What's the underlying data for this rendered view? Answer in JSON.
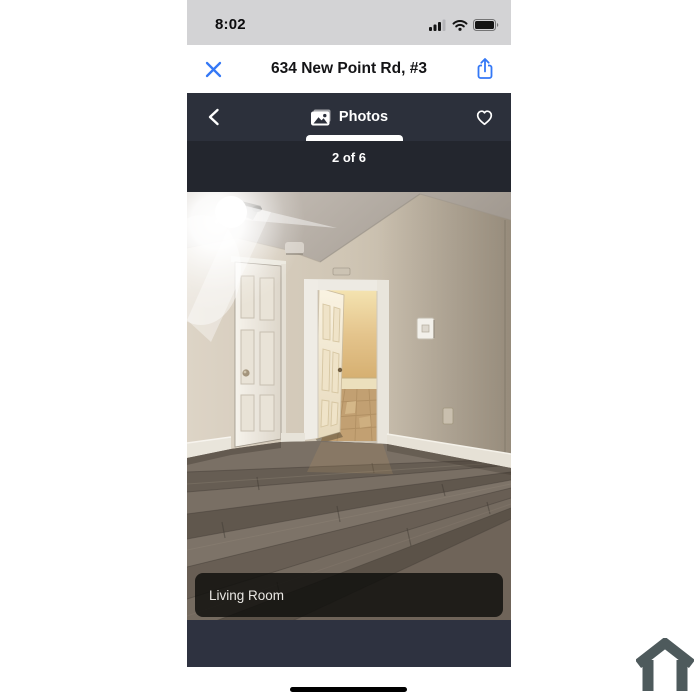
{
  "status_bar": {
    "time": "8:02",
    "signal_icon": "cellular-signal-icon",
    "wifi_icon": "wifi-icon",
    "battery_icon": "battery-icon"
  },
  "sheet_header": {
    "title": "634 New Point Rd, #3",
    "close_icon": "x-icon",
    "share_icon": "ios-share-icon"
  },
  "photo_nav": {
    "back_icon": "chevron-left-icon",
    "tab_label": "Photos",
    "tab_icon": "photos-icon",
    "favorite_icon": "heart-outline-icon"
  },
  "photo_viewer": {
    "counter": "2 of 6",
    "caption": "Living Room",
    "photo_description": "Empty living room: beige walls, gray wood-plank floor, closed white six-panel door, open door to lit hallway with tile floor, bright camera-flash glare upper left, thermostat on right wall"
  },
  "system": {
    "home_indicator": "home-indicator-bar"
  },
  "branding": {
    "logo_icon": "house-outline-icon"
  },
  "colors": {
    "accent_blue": "#3478F6",
    "status_bar_bg": "#d3d3d5",
    "nav_bg": "#2c303b",
    "counter_bg": "#23262e",
    "bottom_band_bg": "#2e3240",
    "caption_bg": "rgba(14,13,11,0.82)",
    "house_logo": "#4e5a5c",
    "floor_wood": "#6e655b",
    "wall_beige": "#cfc5b4"
  }
}
